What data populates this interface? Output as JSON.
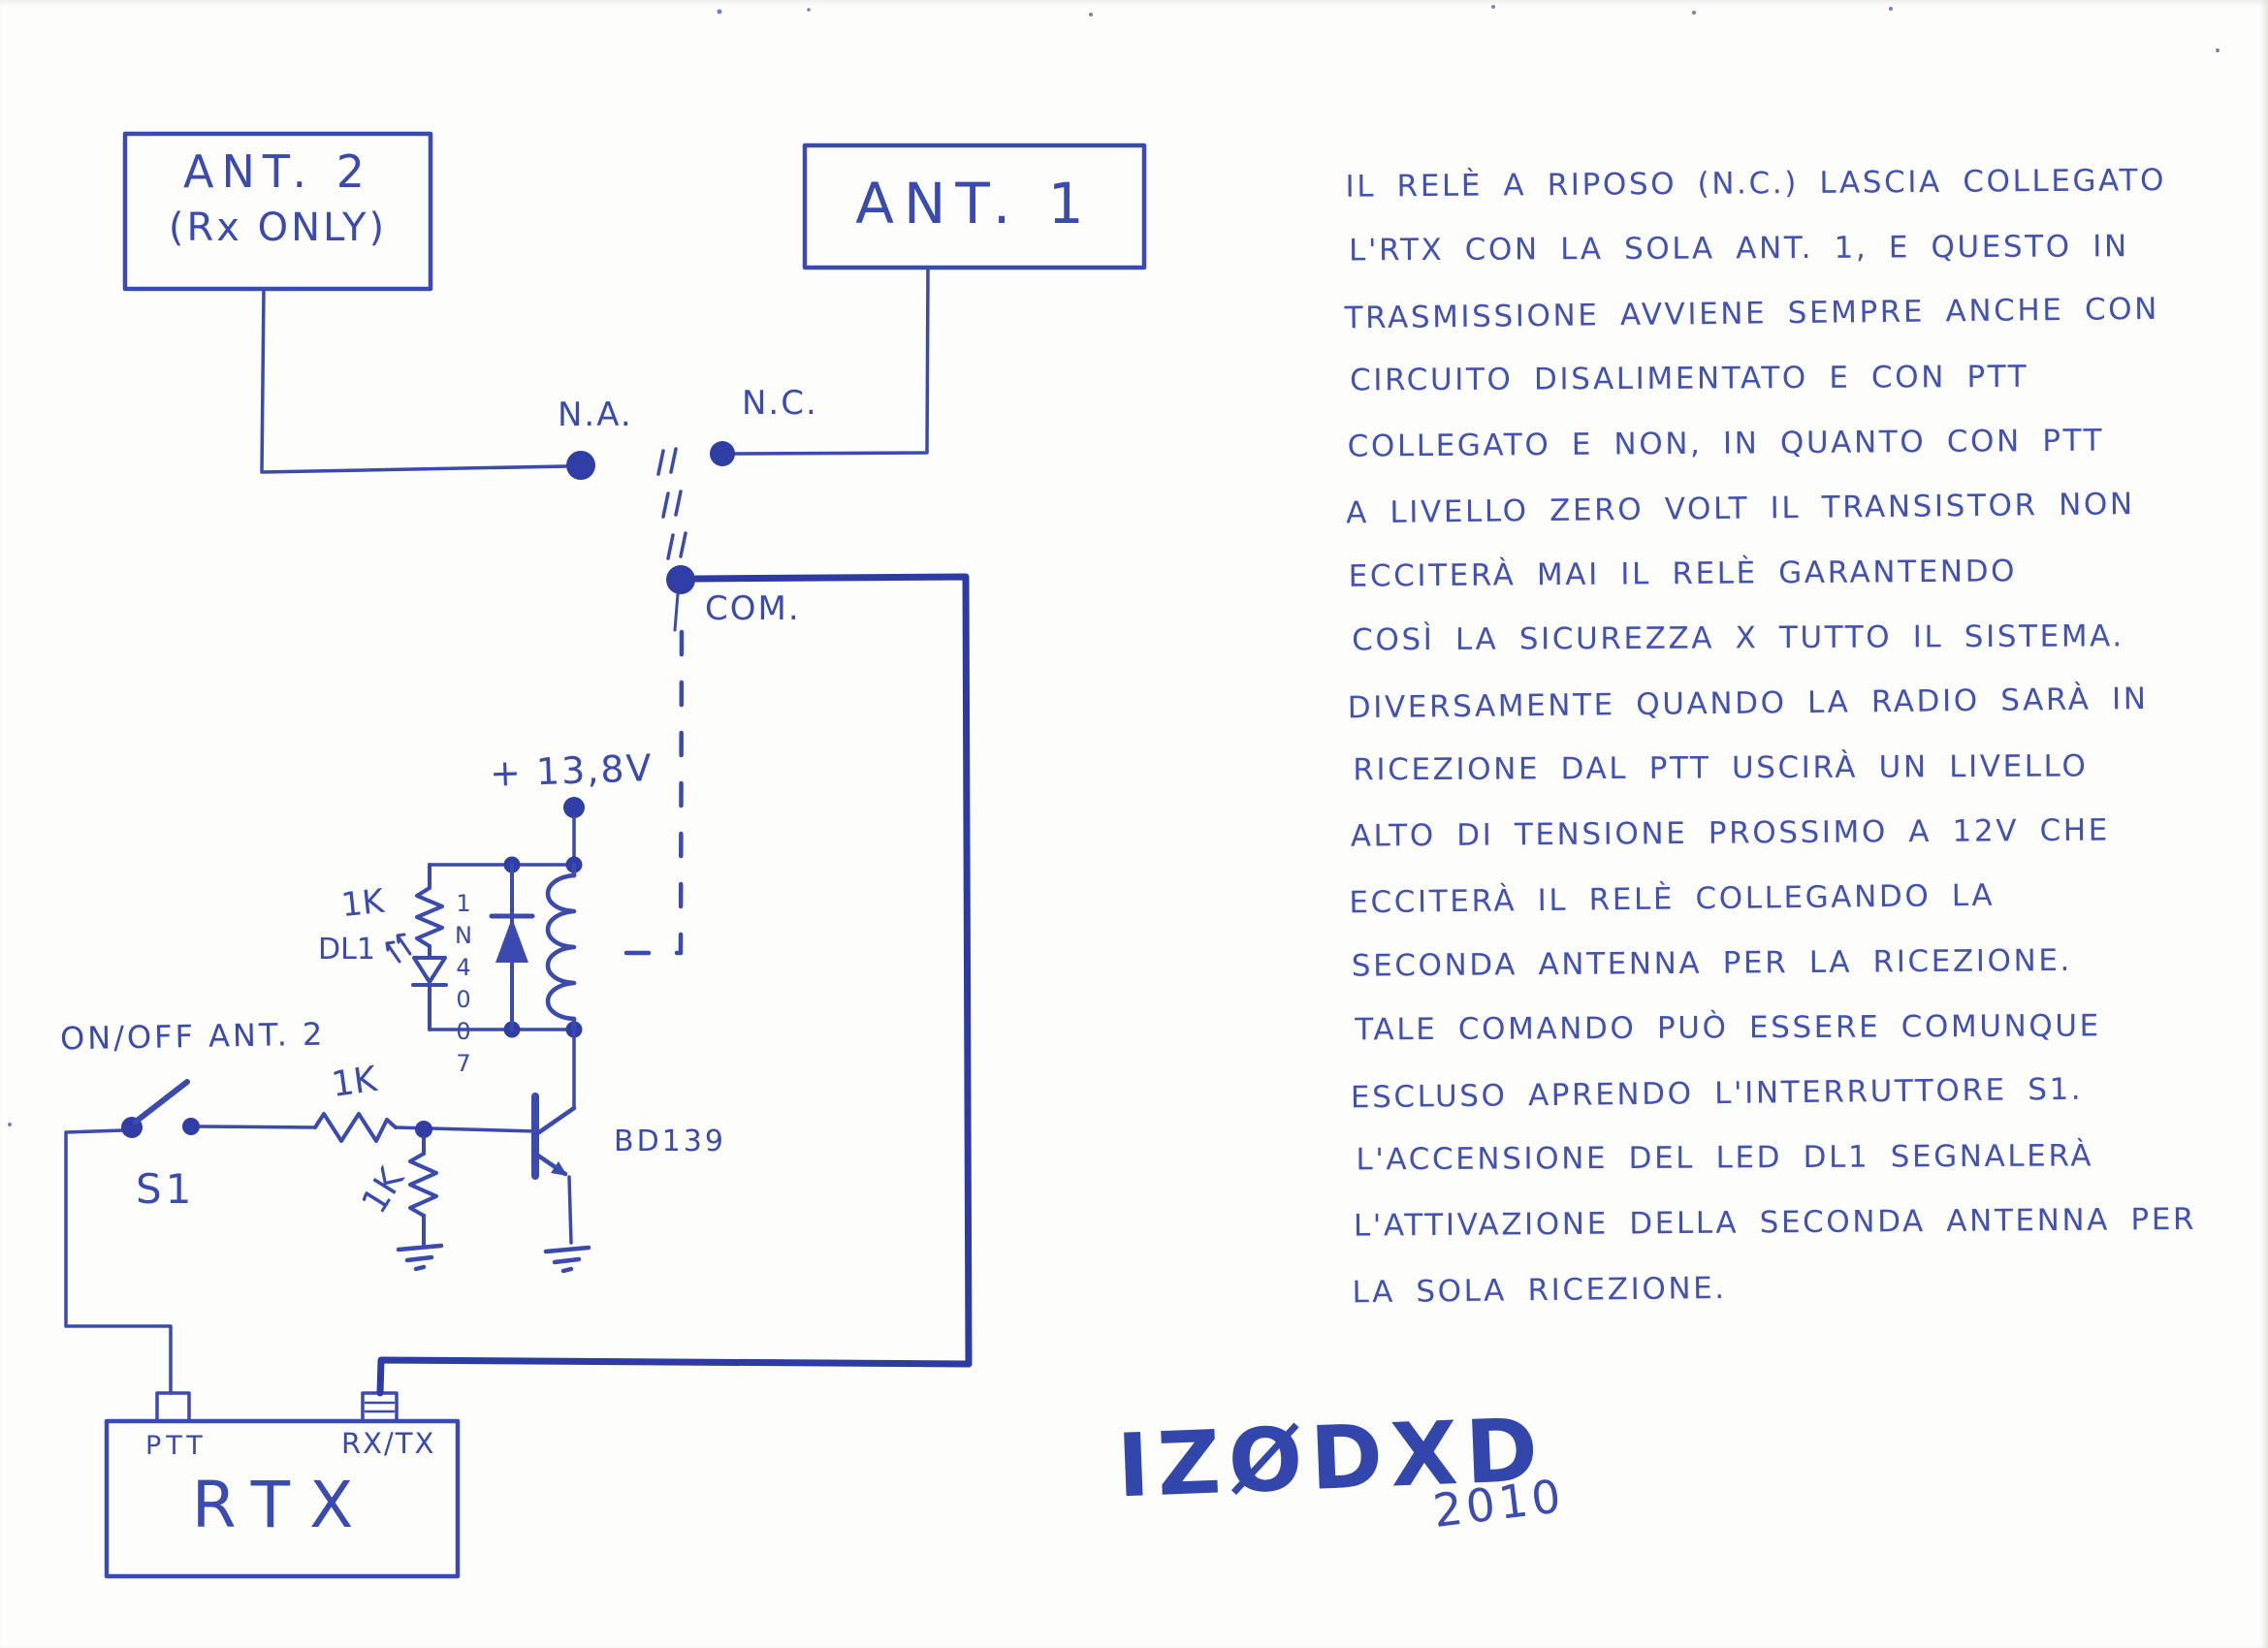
{
  "page": {
    "ink_color": "#3a4aae",
    "thick_wire_color": "#2d3ba2",
    "paper_color": "#fdfdfb"
  },
  "schematic": {
    "ant2_box": {
      "line1": "ANT. 2",
      "line2": "(Rx ONLY)"
    },
    "ant1_box": {
      "label": "ANT. 1"
    },
    "relay": {
      "na_label": "N.A.",
      "nc_label": "N.C.",
      "com_label": "COM.",
      "supply_label": "+ 13,8V",
      "led_resistor_label": "1K",
      "led_label": "DL1",
      "flyback_diode_label": "1N4007"
    },
    "driver": {
      "switch_title": "ON/OFF ANT. 2",
      "switch_label": "S1",
      "base_resistor_label": "1K",
      "pulldown_resistor_label": "1K",
      "transistor_label": "BD139"
    },
    "rtx_box": {
      "ptt_label": "PTT",
      "rxtx_label": "RX/TX",
      "label": "RTX"
    }
  },
  "notes": {
    "lines": [
      "IL RELÈ A RIPOSO (N.C.) LASCIA COLLEGATO",
      "L'RTX CON LA SOLA ANT. 1, E QUESTO IN",
      "TRASMISSIONE AVVIENE SEMPRE ANCHE CON",
      "CIRCUITO DISALIMENTATO E CON PTT",
      "COLLEGATO E NON, IN QUANTO CON PTT",
      "A LIVELLO ZERO VOLT IL TRANSISTOR NON",
      "ECCITERÀ MAI IL RELÈ GARANTENDO",
      "COSÌ LA SICUREZZA X TUTTO IL SISTEMA.",
      "DIVERSAMENTE QUANDO LA RADIO SARÀ IN",
      "RICEZIONE DAL PTT USCIRÀ UN LIVELLO",
      "ALTO DI TENSIONE PROSSIMO A 12V CHE",
      "ECCITERÀ IL RELÈ COLLEGANDO LA",
      "SECONDA ANTENNA PER LA RICEZIONE.",
      "TALE COMANDO PUÒ ESSERE COMUNQUE",
      "ESCLUSO APRENDO L'INTERRUTTORE S1.",
      "L'ACCENSIONE DEL LED DL1 SEGNALERÀ",
      "L'ATTIVAZIONE DELLA SECONDA ANTENNA PER",
      "LA SOLA RICEZIONE."
    ]
  },
  "signature": {
    "callsign": "IZØDXD",
    "year": "2010"
  }
}
